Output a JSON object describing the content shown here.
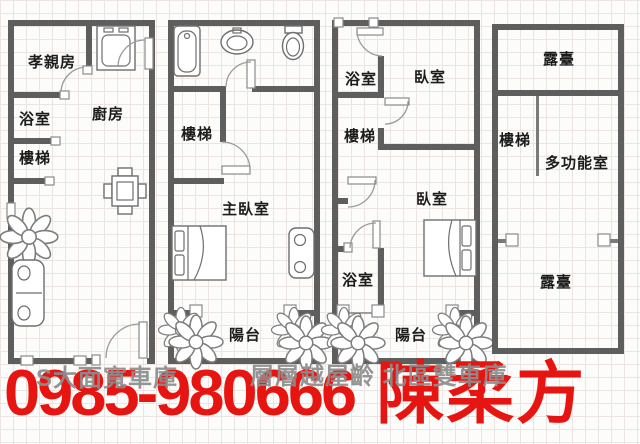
{
  "colors": {
    "wall": "#5e5e5e",
    "line": "#6e6e6e",
    "accent_red": "#e71511",
    "watermark_gray": "#8d8d8d",
    "grid": "#ece4e0",
    "paper": "#fcfcfa"
  },
  "plans": {
    "floor1": {
      "labels": {
        "parents_room": "孝親房",
        "bathroom": "浴室",
        "stairs": "樓梯",
        "kitchen": "廚房"
      }
    },
    "floor2": {
      "labels": {
        "stairs": "樓梯",
        "master_bedroom": "主臥室",
        "balcony": "陽台"
      }
    },
    "floor3": {
      "labels": {
        "bathroom_top": "浴室",
        "bedroom_top": "臥室",
        "stairs": "樓梯",
        "bedroom_bottom": "臥室",
        "bathroom_bottom": "浴室",
        "balcony": "陽台"
      }
    },
    "floor4": {
      "labels": {
        "terrace_top": "露臺",
        "stairs": "樓梯",
        "multipurpose_room": "多功能室",
        "terrace_bottom": "露臺"
      }
    }
  },
  "icons": [
    "stove-icon",
    "dining-table-icon",
    "plant-icon",
    "sofa-icon",
    "bathtub-icon",
    "washbasin-icon",
    "toilet-icon",
    "double-bed-icon",
    "armchair-icon",
    "door-swing-icon",
    "window-icon",
    "balcony-post-icon"
  ],
  "watermarks": {
    "left": "S大面寬車庫",
    "right": "層層越屋齡 北區雙車庫"
  },
  "contact": {
    "phone": "0985-980666",
    "agent": "陳柔方"
  }
}
